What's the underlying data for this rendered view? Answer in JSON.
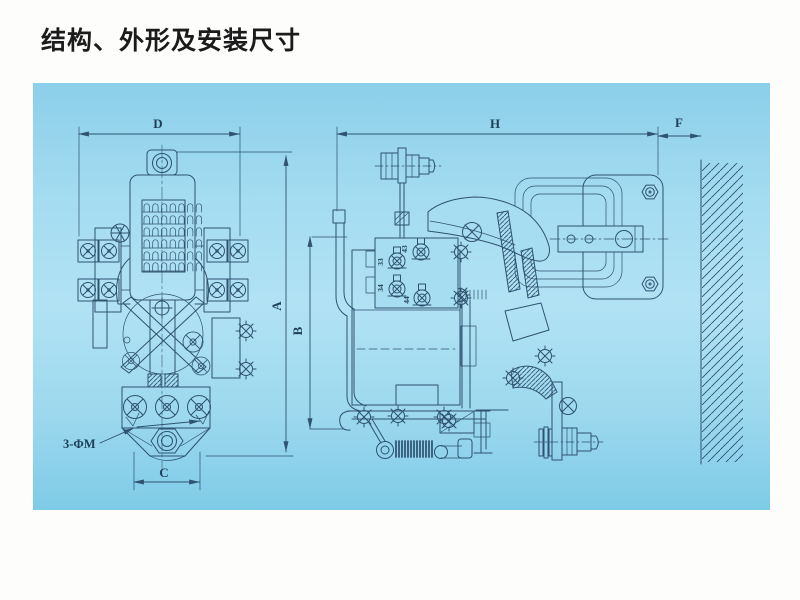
{
  "title": "结构、外形及安装尺寸",
  "panel": {
    "background_light": "#b1e2f4",
    "background_mid": "#93d4ec",
    "background_dark": "#7ecbe7",
    "line_color": "#2e5270"
  },
  "front_view": {
    "dim_width": "D",
    "dim_height": "A",
    "dim_base_width": "C",
    "mounting_holes_label": "3-ΦM"
  },
  "side_view": {
    "dim_width": "H",
    "dim_wall_gap": "F",
    "dim_height": "B",
    "terminal_labels": [
      "43",
      "33",
      "34",
      "44"
    ]
  }
}
